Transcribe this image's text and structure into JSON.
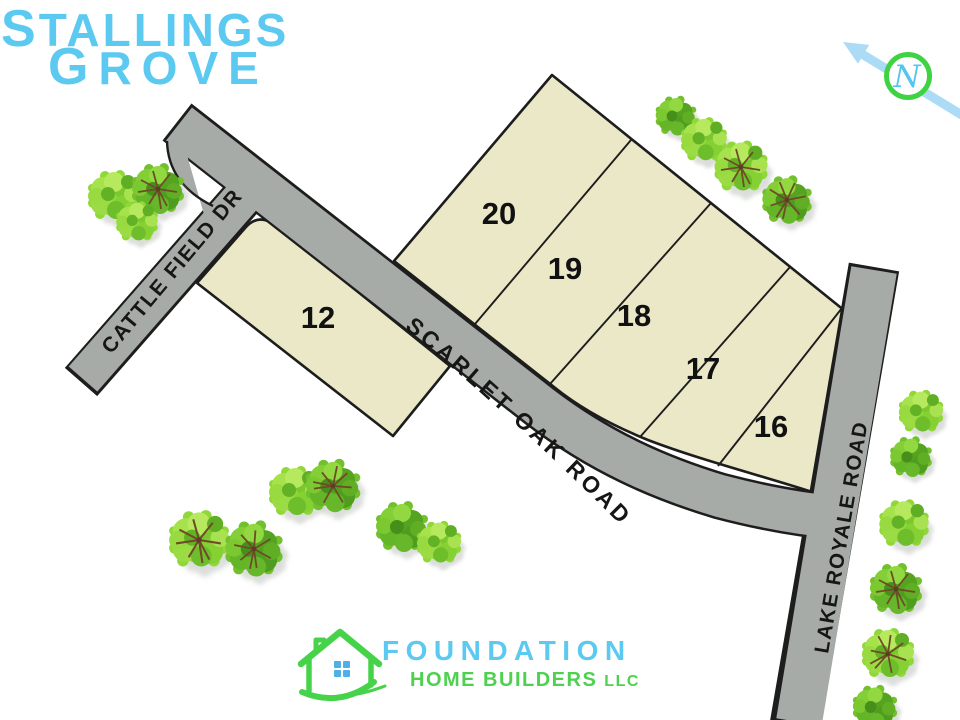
{
  "title": {
    "word1_initial": "S",
    "word1_rest": "TALLINGS",
    "word2_initial": "G",
    "word2_rest": "ROVE"
  },
  "compass": {
    "north_label": "N"
  },
  "roads": {
    "cattle_field": "CATTLE FIELD DR",
    "scarlet_oak": "SCARLET OAK ROAD",
    "lake_royale": "LAKE ROYALE ROAD"
  },
  "lots": {
    "lot12": "12",
    "lot16": "16",
    "lot17": "17",
    "lot18": "18",
    "lot19": "19",
    "lot20": "20"
  },
  "logo": {
    "name": "FOUNDATION",
    "subtitle": "HOME BUILDERS",
    "suffix": "LLC"
  },
  "colors": {
    "title_blue": "#5BC9F0",
    "logo_green": "#4DD14E",
    "parcel_fill": "#EBE8C8",
    "road_gray": "#A6ABA7",
    "outline_dark": "#1D1D1D",
    "compass_ring_green": "#3FD343",
    "arrow_blue": "#ACDCF5"
  }
}
